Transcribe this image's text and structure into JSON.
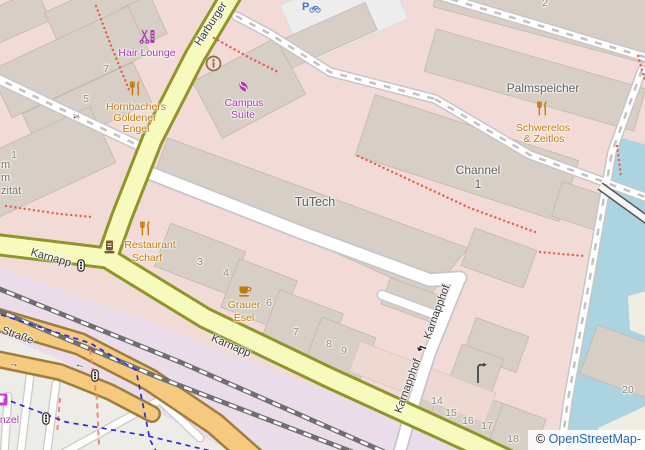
{
  "streets": {
    "harburger": "Harburger",
    "karnapp_a": "Karnapp",
    "karnapp_b": "Karnapp",
    "er_strasse": "er Straße",
    "karnapphof_a": "Karnapphof",
    "karnapphof_b": "Karnapphof"
  },
  "pois": {
    "hair_lounge": "Hair Lounge",
    "hornbachers_1": "Hornbachers",
    "hornbachers_2": "Goldener",
    "hornbachers_3": "Engel",
    "campus_1": "Campus",
    "campus_2": "Suite",
    "scharf_1": "Restaurant",
    "scharf_2": "Scharf",
    "grauer_1": "Grauer",
    "grauer_2": "Esel",
    "schwerelos_1": "Schwerelos",
    "schwerelos_2": "& Zeitlos",
    "palmspeicher": "Palmspeicher",
    "channel_1": "Channel",
    "channel_2": "1",
    "tutech": "TuTech",
    "shop_partial": "enzel",
    "frag_1": "m",
    "frag_2": "m",
    "frag_3": "zität"
  },
  "house_numbers": {
    "a7": "7",
    "a5": "5",
    "a1": "1",
    "a3": "3",
    "a4": "4",
    "a6": "6",
    "b7": "7",
    "a8": "8",
    "a9": "9",
    "a14": "14",
    "a15": "15",
    "a16": "16",
    "a17": "17",
    "a18": "18",
    "a20": "20",
    "a2": "2"
  },
  "icons": {
    "bicycle_parking": "P",
    "oneway_right": "→",
    "oneway_left": "←",
    "oneway_left_2": "←",
    "oneway_hook": "↰"
  },
  "attribution": {
    "copyright": "©",
    "link": "OpenStreetMap-"
  },
  "colors": {
    "road_tertiary": "#f7fabd",
    "road_secondary": "#f5c97e",
    "water": "#abd4e0",
    "railway_area": "#eadce9",
    "building": "#d7cfc6",
    "retail_area": "#f2dbd6",
    "poi_shop": "#ac39ac",
    "poi_amenity": "#c1790a",
    "cycleway": "#2a2ae2",
    "footpath_dots": "#e2614f",
    "attribution_link": "#2a64b0"
  }
}
